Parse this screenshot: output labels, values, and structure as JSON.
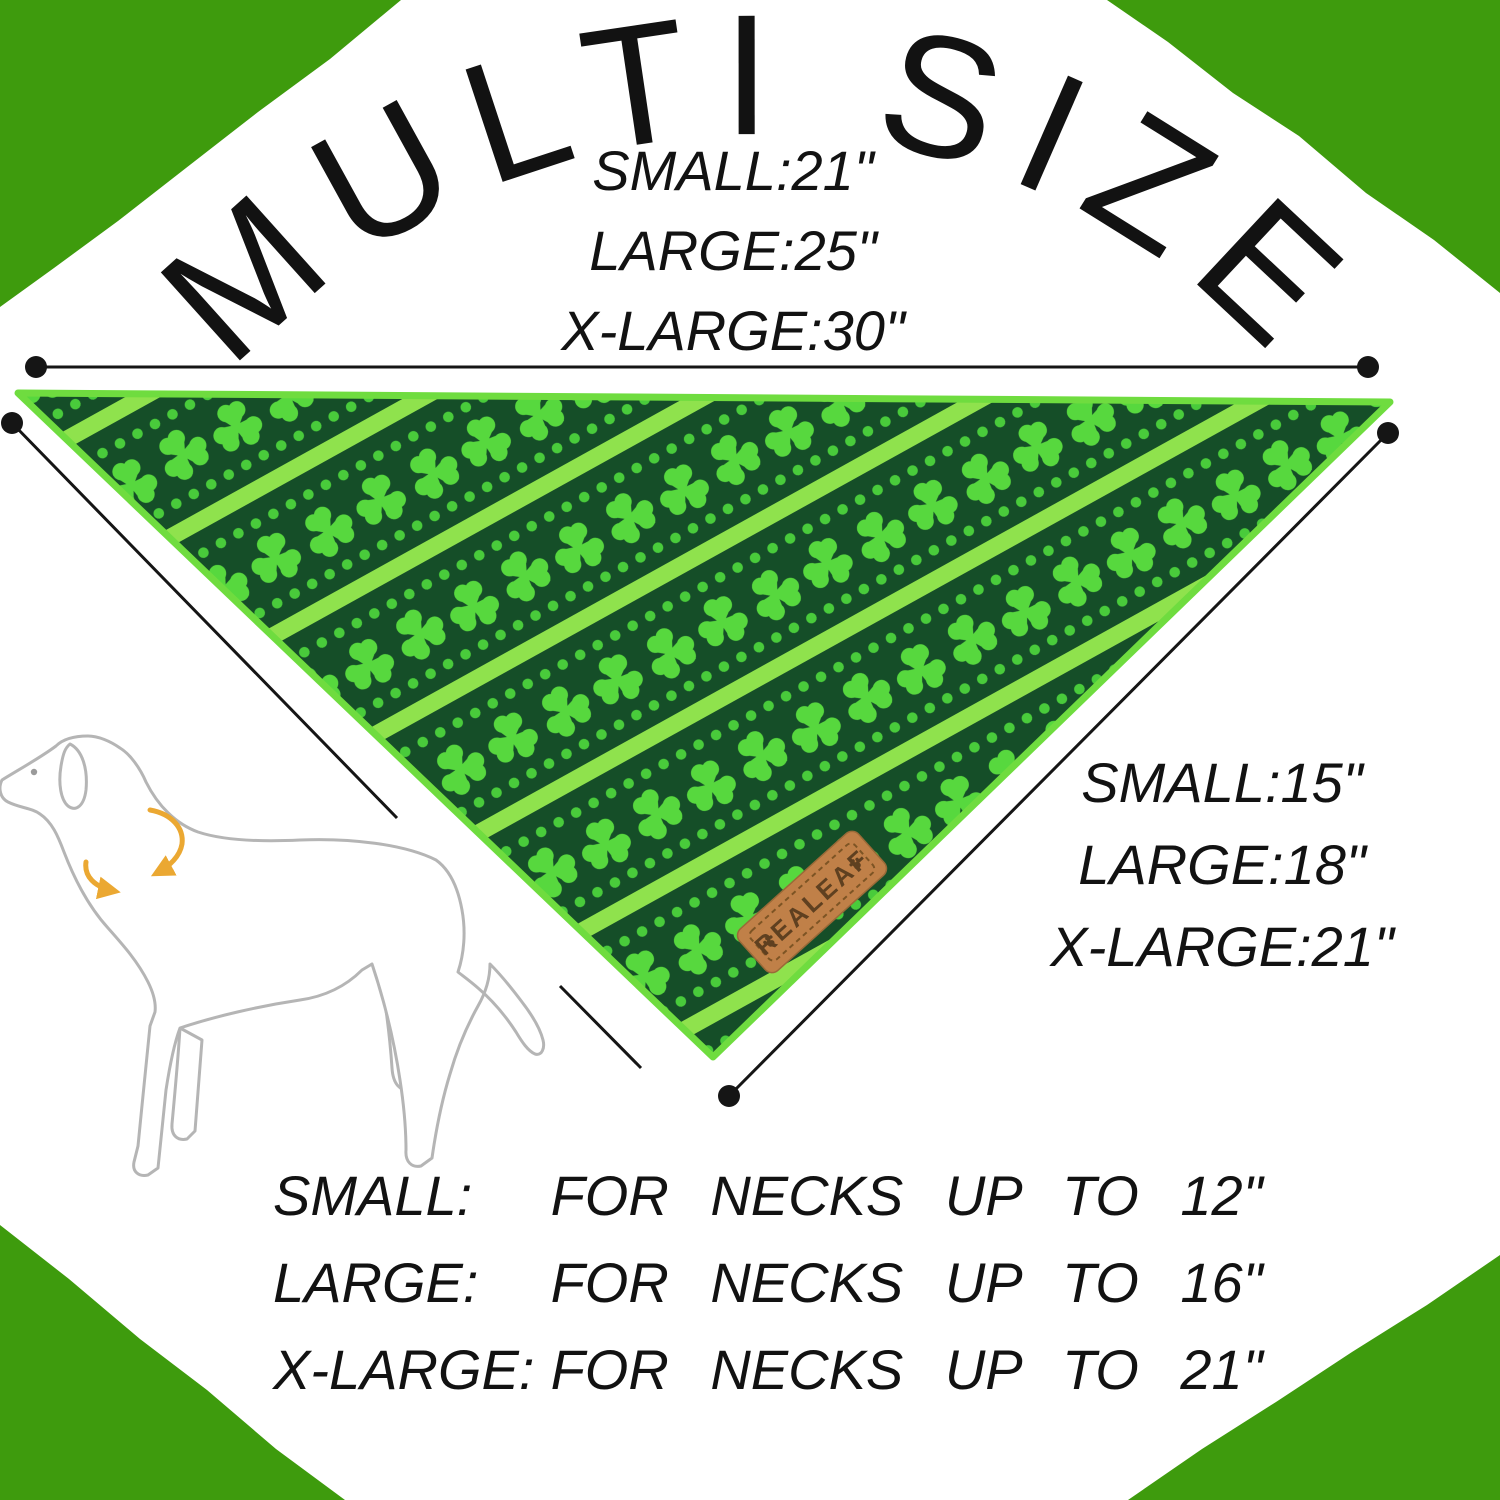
{
  "arc_title": "MULTI SIZE",
  "folded_sizes": [
    "SMALL:21\"",
    "LARGE:25\"",
    "X-LARGE:30\""
  ],
  "edge_sizes": [
    "SMALL:15\"",
    "LARGE:18\"",
    "X-LARGE:21\""
  ],
  "neck_rows": [
    {
      "label": "SMALL:",
      "desc": "FOR NECKS UP TO 12\""
    },
    {
      "label": "LARGE:",
      "desc": "FOR NECKS UP TO 16\""
    },
    {
      "label": "X-LARGE:",
      "desc": "FOR NECKS UP TO 21\""
    }
  ],
  "tag_brand": "REALEAF",
  "icons": {
    "tag_paw_icon": "paw-print",
    "neck_arrows_icon": "circular-measure-arrows"
  },
  "colors": {
    "corner_green": "#3e9b0d",
    "bandana_dark_green": "#154e28",
    "stripe_green": "#8fe24d",
    "dot_green": "#49cb3b",
    "clover_green": "#57d83e",
    "trim_green": "#6fdc3f",
    "tag_leather": "#c08048",
    "tag_stitch": "#7d5424",
    "tag_text": "#5f4020",
    "arrow_gold": "#eba832",
    "dog_outline_gray": "#b5b5b5",
    "measure_line_black": "#151515",
    "text_black": "#121212"
  }
}
